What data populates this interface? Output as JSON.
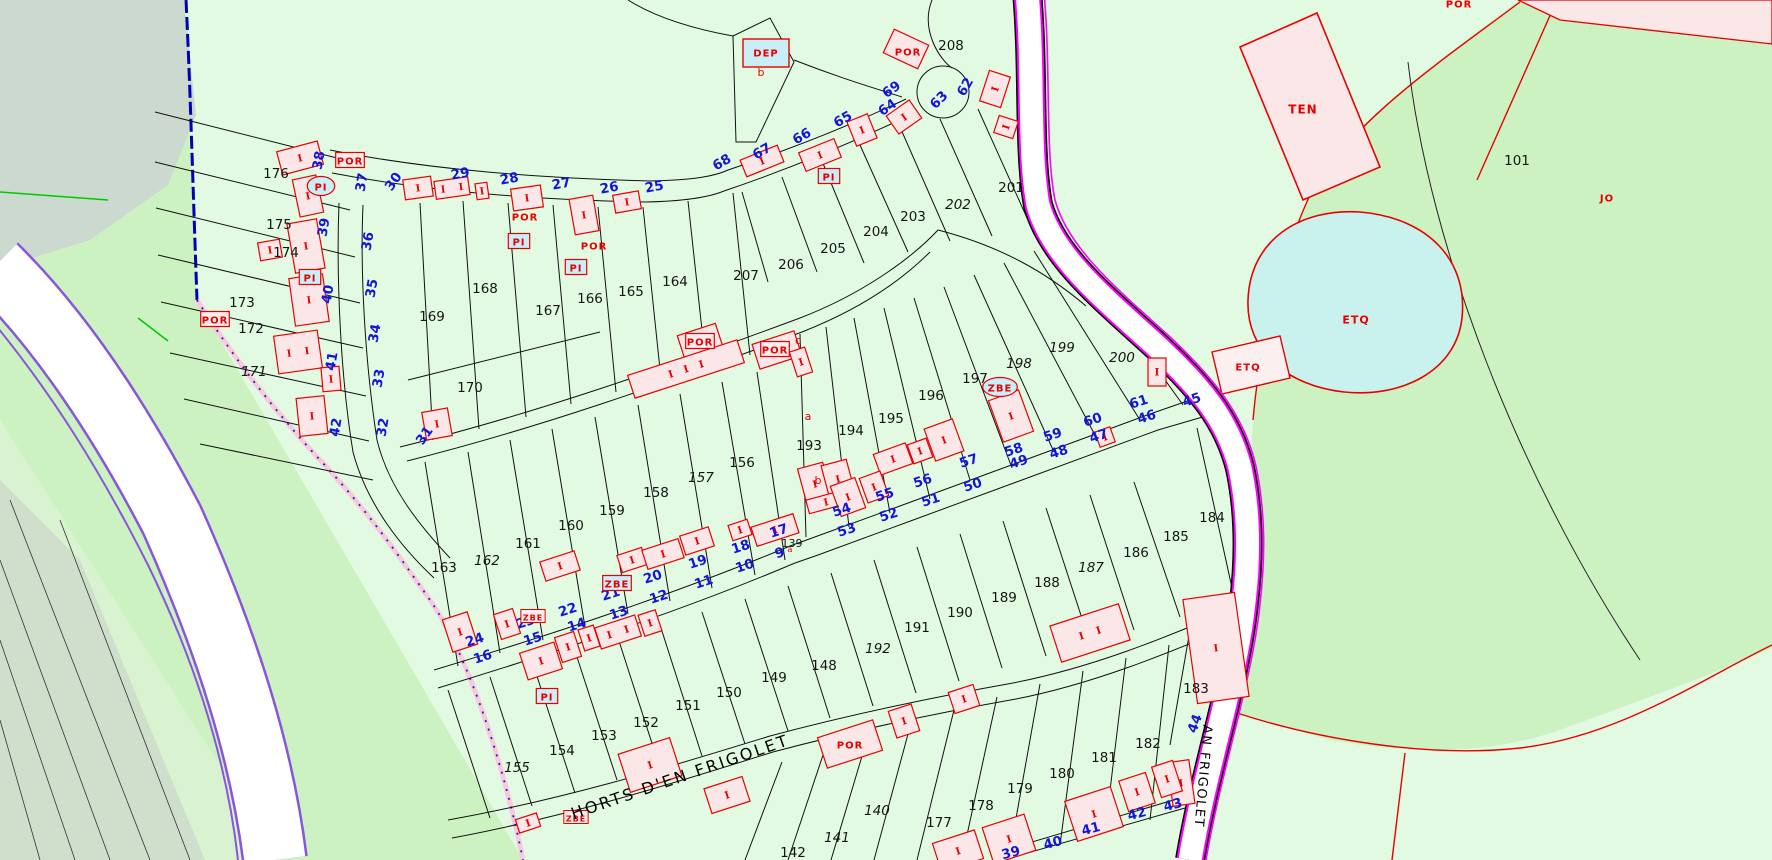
{
  "map": {
    "title": "cadastral parcel map",
    "colors": {
      "bg_light_green": "#E2FAE2",
      "medium_green": "#CDF2C2",
      "gray_green_tl": "#CCD9CE",
      "gray_green_bl": "#CFDFCB",
      "pale_west": "#D9F2CF",
      "road_white": "#FFFFFF",
      "road_violet": "#8A55DD",
      "road_magenta": "#FF00FF",
      "boundary_blue": "#0000B4",
      "boundary_pink": "#F9C9DC",
      "parcel_line": "#111111",
      "building_fill": "#FBE7E7",
      "building_red": "#E80000",
      "cyan_box": "#C9EEF8",
      "pond_fill": "#C9F2EE",
      "house_number_blue": "#1515D8",
      "green_line": "#00C800"
    },
    "street_names": [
      {
        "t": "HORTS D'EN FRIGOLET",
        "x": 682,
        "y": 782,
        "r": -19,
        "s": 16,
        "ls": 2.5
      },
      {
        "t": "AN FRIGOLET",
        "x": 1199,
        "y": 776,
        "r": 95,
        "s": 13,
        "ls": 1.5
      }
    ],
    "parcel_labels": [
      {
        "t": "139",
        "x": 792,
        "y": 547,
        "s": 11
      },
      {
        "t": "140",
        "x": 877,
        "y": 815,
        "it": 1
      },
      {
        "t": "141",
        "x": 837,
        "y": 842,
        "it": 1
      },
      {
        "t": "142",
        "x": 793,
        "y": 857
      },
      {
        "t": "148",
        "x": 824,
        "y": 670
      },
      {
        "t": "149",
        "x": 774,
        "y": 682
      },
      {
        "t": "150",
        "x": 729,
        "y": 697
      },
      {
        "t": "151",
        "x": 688,
        "y": 710
      },
      {
        "t": "152",
        "x": 646,
        "y": 727
      },
      {
        "t": "153",
        "x": 604,
        "y": 740
      },
      {
        "t": "154",
        "x": 562,
        "y": 755
      },
      {
        "t": "155",
        "x": 517,
        "y": 772,
        "it": 1
      },
      {
        "t": "156",
        "x": 742,
        "y": 467
      },
      {
        "t": "157",
        "x": 701,
        "y": 482,
        "it": 1
      },
      {
        "t": "158",
        "x": 656,
        "y": 497
      },
      {
        "t": "159",
        "x": 612,
        "y": 515
      },
      {
        "t": "160",
        "x": 571,
        "y": 530
      },
      {
        "t": "161",
        "x": 528,
        "y": 548
      },
      {
        "t": "162",
        "x": 487,
        "y": 565,
        "it": 1
      },
      {
        "t": "163",
        "x": 444,
        "y": 572
      },
      {
        "t": "164",
        "x": 675,
        "y": 286
      },
      {
        "t": "165",
        "x": 631,
        "y": 296
      },
      {
        "t": "166",
        "x": 590,
        "y": 303
      },
      {
        "t": "167",
        "x": 548,
        "y": 315
      },
      {
        "t": "168",
        "x": 485,
        "y": 293
      },
      {
        "t": "169",
        "x": 432,
        "y": 321
      },
      {
        "t": "170",
        "x": 470,
        "y": 392
      },
      {
        "t": "171",
        "x": 254,
        "y": 376,
        "it": 1
      },
      {
        "t": "172",
        "x": 251,
        "y": 333
      },
      {
        "t": "173",
        "x": 242,
        "y": 307
      },
      {
        "t": "174",
        "x": 286,
        "y": 257
      },
      {
        "t": "175",
        "x": 279,
        "y": 229
      },
      {
        "t": "176",
        "x": 276,
        "y": 178
      },
      {
        "t": "177",
        "x": 939,
        "y": 827
      },
      {
        "t": "178",
        "x": 981,
        "y": 810
      },
      {
        "t": "179",
        "x": 1020,
        "y": 793
      },
      {
        "t": "180",
        "x": 1062,
        "y": 778
      },
      {
        "t": "181",
        "x": 1104,
        "y": 762
      },
      {
        "t": "182",
        "x": 1148,
        "y": 748
      },
      {
        "t": "183",
        "x": 1196,
        "y": 693
      },
      {
        "t": "184",
        "x": 1212,
        "y": 522
      },
      {
        "t": "185",
        "x": 1176,
        "y": 541
      },
      {
        "t": "186",
        "x": 1136,
        "y": 557
      },
      {
        "t": "187",
        "x": 1091,
        "y": 572,
        "it": 1
      },
      {
        "t": "188",
        "x": 1047,
        "y": 587
      },
      {
        "t": "189",
        "x": 1004,
        "y": 602
      },
      {
        "t": "190",
        "x": 960,
        "y": 617
      },
      {
        "t": "191",
        "x": 917,
        "y": 632
      },
      {
        "t": "192",
        "x": 878,
        "y": 653,
        "it": 1
      },
      {
        "t": "193",
        "x": 809,
        "y": 450
      },
      {
        "t": "194",
        "x": 851,
        "y": 435
      },
      {
        "t": "195",
        "x": 891,
        "y": 423
      },
      {
        "t": "196",
        "x": 931,
        "y": 400
      },
      {
        "t": "197",
        "x": 975,
        "y": 383
      },
      {
        "t": "198",
        "x": 1019,
        "y": 368,
        "it": 1
      },
      {
        "t": "199",
        "x": 1062,
        "y": 352,
        "it": 1
      },
      {
        "t": "200",
        "x": 1122,
        "y": 362,
        "it": 1
      },
      {
        "t": "201",
        "x": 1011,
        "y": 192
      },
      {
        "t": "202",
        "x": 958,
        "y": 209,
        "it": 1
      },
      {
        "t": "203",
        "x": 913,
        "y": 221
      },
      {
        "t": "204",
        "x": 876,
        "y": 236
      },
      {
        "t": "205",
        "x": 833,
        "y": 253
      },
      {
        "t": "206",
        "x": 791,
        "y": 269
      },
      {
        "t": "207",
        "x": 746,
        "y": 280
      },
      {
        "t": "208",
        "x": 951,
        "y": 50
      },
      {
        "t": "101",
        "x": 1517,
        "y": 165
      }
    ],
    "house_numbers": [
      {
        "t": "25",
        "x": 655,
        "y": 191,
        "r": -10
      },
      {
        "t": "26",
        "x": 610,
        "y": 192,
        "r": -10
      },
      {
        "t": "27",
        "x": 562,
        "y": 188,
        "r": -10
      },
      {
        "t": "28",
        "x": 510,
        "y": 183,
        "r": -10
      },
      {
        "t": "29",
        "x": 461,
        "y": 178,
        "r": -10
      },
      {
        "t": "30",
        "x": 397,
        "y": 184,
        "r": -55
      },
      {
        "t": "37",
        "x": 366,
        "y": 183,
        "r": -80
      },
      {
        "t": "36",
        "x": 372,
        "y": 242,
        "r": -80
      },
      {
        "t": "35",
        "x": 376,
        "y": 289,
        "r": -80
      },
      {
        "t": "34",
        "x": 379,
        "y": 334,
        "r": -80
      },
      {
        "t": "33",
        "x": 383,
        "y": 379,
        "r": -80
      },
      {
        "t": "32",
        "x": 387,
        "y": 428,
        "r": -80
      },
      {
        "t": "31",
        "x": 428,
        "y": 438,
        "r": -55
      },
      {
        "t": "38",
        "x": 323,
        "y": 161,
        "r": -80
      },
      {
        "t": "39",
        "x": 328,
        "y": 228,
        "r": -80
      },
      {
        "t": "40",
        "x": 332,
        "y": 295,
        "r": -80
      },
      {
        "t": "41",
        "x": 336,
        "y": 362,
        "r": -80
      },
      {
        "t": "42",
        "x": 340,
        "y": 428,
        "r": -80
      },
      {
        "t": "68",
        "x": 724,
        "y": 166,
        "r": -30
      },
      {
        "t": "67",
        "x": 764,
        "y": 155,
        "r": -30
      },
      {
        "t": "66",
        "x": 804,
        "y": 140,
        "r": -30
      },
      {
        "t": "65",
        "x": 845,
        "y": 123,
        "r": -30
      },
      {
        "t": "64",
        "x": 890,
        "y": 111,
        "r": -35
      },
      {
        "t": "69",
        "x": 894,
        "y": 93,
        "r": -35
      },
      {
        "t": "63",
        "x": 942,
        "y": 103,
        "r": -45
      },
      {
        "t": "62",
        "x": 969,
        "y": 89,
        "r": -60
      },
      {
        "t": "24",
        "x": 476,
        "y": 644,
        "r": -18
      },
      {
        "t": "23",
        "x": 527,
        "y": 626,
        "r": -18
      },
      {
        "t": "22",
        "x": 569,
        "y": 614,
        "r": -18
      },
      {
        "t": "21",
        "x": 612,
        "y": 598,
        "r": -18
      },
      {
        "t": "20",
        "x": 654,
        "y": 581,
        "r": -18
      },
      {
        "t": "19",
        "x": 699,
        "y": 566,
        "r": -18
      },
      {
        "t": "18",
        "x": 742,
        "y": 551,
        "r": -18
      },
      {
        "t": "17",
        "x": 780,
        "y": 535,
        "r": -18
      },
      {
        "t": "16",
        "x": 484,
        "y": 661,
        "r": -18
      },
      {
        "t": "15",
        "x": 534,
        "y": 643,
        "r": -18
      },
      {
        "t": "14",
        "x": 578,
        "y": 629,
        "r": -18
      },
      {
        "t": "13",
        "x": 620,
        "y": 617,
        "r": -18
      },
      {
        "t": "12",
        "x": 660,
        "y": 601,
        "r": -18
      },
      {
        "t": "11",
        "x": 705,
        "y": 586,
        "r": -18
      },
      {
        "t": "10",
        "x": 746,
        "y": 570,
        "r": -18
      },
      {
        "t": "9",
        "x": 781,
        "y": 557,
        "r": -18
      },
      {
        "t": "54",
        "x": 843,
        "y": 514,
        "r": -18
      },
      {
        "t": "55",
        "x": 886,
        "y": 499,
        "r": -18
      },
      {
        "t": "56",
        "x": 924,
        "y": 485,
        "r": -18
      },
      {
        "t": "57",
        "x": 970,
        "y": 465,
        "r": -18
      },
      {
        "t": "58",
        "x": 1015,
        "y": 454,
        "r": -18
      },
      {
        "t": "59",
        "x": 1054,
        "y": 439,
        "r": -18
      },
      {
        "t": "60",
        "x": 1094,
        "y": 424,
        "r": -18
      },
      {
        "t": "61",
        "x": 1140,
        "y": 406,
        "r": -18
      },
      {
        "t": "53",
        "x": 848,
        "y": 534,
        "r": -18
      },
      {
        "t": "52",
        "x": 890,
        "y": 519,
        "r": -18
      },
      {
        "t": "51",
        "x": 932,
        "y": 504,
        "r": -18
      },
      {
        "t": "50",
        "x": 974,
        "y": 489,
        "r": -18
      },
      {
        "t": "49",
        "x": 1020,
        "y": 466,
        "r": -18
      },
      {
        "t": "48",
        "x": 1060,
        "y": 456,
        "r": -18
      },
      {
        "t": "47",
        "x": 1100,
        "y": 440,
        "r": -18
      },
      {
        "t": "46",
        "x": 1148,
        "y": 421,
        "r": -18
      },
      {
        "t": "45",
        "x": 1193,
        "y": 404,
        "r": -18
      },
      {
        "t": "44",
        "x": 1199,
        "y": 725,
        "r": -70
      },
      {
        "t": "43",
        "x": 1174,
        "y": 809,
        "r": -15
      },
      {
        "t": "42",
        "x": 1138,
        "y": 818,
        "r": -15
      },
      {
        "t": "41",
        "x": 1092,
        "y": 833,
        "r": -15
      },
      {
        "t": "40",
        "x": 1054,
        "y": 847,
        "r": -15
      },
      {
        "t": "39",
        "x": 1012,
        "y": 857,
        "r": -15
      }
    ],
    "codes": [
      {
        "t": "POR",
        "x": 350,
        "y": 161,
        "k": "b"
      },
      {
        "t": "POR",
        "x": 215,
        "y": 320,
        "k": "b"
      },
      {
        "t": "POR",
        "x": 525,
        "y": 217,
        "k": "p"
      },
      {
        "t": "POR",
        "x": 594,
        "y": 246,
        "k": "p"
      },
      {
        "t": "POR",
        "x": 700,
        "y": 342,
        "k": "b"
      },
      {
        "t": "POR",
        "x": 775,
        "y": 350,
        "k": "b"
      },
      {
        "t": "POR",
        "x": 908,
        "y": 52,
        "k": "p"
      },
      {
        "t": "POR",
        "x": 850,
        "y": 745,
        "k": "p"
      },
      {
        "t": "POR",
        "x": 1459,
        "y": 4,
        "k": "p"
      },
      {
        "t": "DEP",
        "x": 766,
        "y": 53,
        "k": "d"
      },
      {
        "t": "PI",
        "x": 321,
        "y": 187,
        "k": "e"
      },
      {
        "t": "PI",
        "x": 310,
        "y": 278,
        "k": "c"
      },
      {
        "t": "PI",
        "x": 519,
        "y": 242,
        "k": "c"
      },
      {
        "t": "PI",
        "x": 576,
        "y": 268,
        "k": "c"
      },
      {
        "t": "PI",
        "x": 829,
        "y": 177,
        "k": "c"
      },
      {
        "t": "PI",
        "x": 547,
        "y": 697,
        "k": "c"
      },
      {
        "t": "ZBE",
        "x": 617,
        "y": 584,
        "k": "c"
      },
      {
        "t": "ZBE",
        "x": 1000,
        "y": 388,
        "k": "e"
      },
      {
        "t": "ZBE",
        "x": 533,
        "y": 617,
        "k": "t"
      },
      {
        "t": "ZBE",
        "x": 576,
        "y": 818,
        "k": "t"
      },
      {
        "t": "TEN",
        "x": 1303,
        "y": 110,
        "k": "p",
        "s": 12
      },
      {
        "t": "ETQ",
        "x": 1356,
        "y": 320,
        "k": "p",
        "s": 11
      },
      {
        "t": "ETQ",
        "x": 1248,
        "y": 367,
        "k": "p"
      },
      {
        "t": "JO",
        "x": 1607,
        "y": 198,
        "k": "p"
      }
    ],
    "building_letters": [
      {
        "t": "b",
        "x": 761,
        "y": 76
      },
      {
        "t": "a",
        "x": 808,
        "y": 420
      },
      {
        "t": "b",
        "x": 818,
        "y": 484
      },
      {
        "t": "c",
        "x": 798,
        "y": 344
      },
      {
        "t": "a",
        "x": 790,
        "y": 552,
        "s": 8
      }
    ]
  },
  "buildings": [
    [
      300,
      158,
      42,
      24,
      -15,
      1
    ],
    [
      308,
      196,
      24,
      38,
      -12,
      1
    ],
    [
      306,
      246,
      30,
      50,
      -10,
      1
    ],
    [
      309,
      300,
      34,
      48,
      -8,
      1
    ],
    [
      298,
      352,
      44,
      38,
      -8,
      2
    ],
    [
      331,
      379,
      18,
      24,
      -5,
      1
    ],
    [
      312,
      416,
      28,
      38,
      -6,
      1
    ],
    [
      270,
      250,
      22,
      18,
      -10,
      1
    ],
    [
      418,
      188,
      28,
      20,
      -8,
      1
    ],
    [
      452,
      188,
      34,
      18,
      -8,
      2
    ],
    [
      482,
      191,
      12,
      16,
      -8,
      1
    ],
    [
      527,
      198,
      30,
      22,
      -8,
      1
    ],
    [
      584,
      215,
      24,
      36,
      -10,
      1
    ],
    [
      627,
      202,
      26,
      18,
      -10,
      1
    ],
    [
      762,
      161,
      40,
      18,
      -22,
      1
    ],
    [
      820,
      155,
      38,
      20,
      -22,
      1
    ],
    [
      862,
      130,
      22,
      26,
      -22,
      1
    ],
    [
      904,
      117,
      28,
      22,
      -35,
      1
    ],
    [
      995,
      89,
      32,
      22,
      -72,
      1
    ],
    [
      1006,
      127,
      18,
      20,
      -72,
      1
    ],
    [
      906,
      49,
      38,
      26,
      25,
      0
    ],
    [
      700,
      341,
      40,
      24,
      -18,
      0
    ],
    [
      777,
      350,
      44,
      26,
      -18,
      0
    ],
    [
      686,
      369,
      115,
      24,
      -18,
      3
    ],
    [
      801,
      362,
      16,
      26,
      -18,
      1
    ],
    [
      815,
      484,
      26,
      38,
      -15,
      1
    ],
    [
      838,
      479,
      26,
      34,
      -15,
      1
    ],
    [
      826,
      502,
      38,
      14,
      -15,
      1
    ],
    [
      437,
      424,
      26,
      28,
      -10,
      1
    ],
    [
      775,
      530,
      44,
      20,
      -18,
      1
    ],
    [
      560,
      566,
      36,
      20,
      -18,
      1
    ],
    [
      632,
      560,
      26,
      18,
      -18,
      1
    ],
    [
      663,
      554,
      38,
      20,
      -18,
      1
    ],
    [
      697,
      541,
      30,
      20,
      -18,
      1
    ],
    [
      740,
      530,
      20,
      16,
      -18,
      1
    ],
    [
      460,
      632,
      26,
      34,
      -18,
      1
    ],
    [
      507,
      624,
      20,
      26,
      -18,
      1
    ],
    [
      541,
      661,
      36,
      28,
      -18,
      1
    ],
    [
      568,
      647,
      20,
      26,
      -18,
      1
    ],
    [
      589,
      638,
      16,
      22,
      -18,
      1
    ],
    [
      618,
      632,
      42,
      22,
      -18,
      2
    ],
    [
      650,
      623,
      18,
      22,
      -18,
      1
    ],
    [
      893,
      459,
      34,
      22,
      -20,
      1
    ],
    [
      920,
      451,
      20,
      20,
      -20,
      1
    ],
    [
      1011,
      416,
      32,
      44,
      -20,
      1
    ],
    [
      1105,
      437,
      16,
      16,
      -20,
      1
    ],
    [
      944,
      440,
      30,
      34,
      -20,
      1
    ],
    [
      848,
      497,
      26,
      32,
      -20,
      1
    ],
    [
      874,
      487,
      22,
      26,
      -20,
      1
    ],
    [
      1216,
      648,
      52,
      105,
      -8,
      1
    ],
    [
      1181,
      783,
      22,
      44,
      -8,
      1
    ],
    [
      650,
      765,
      54,
      40,
      -18,
      1
    ],
    [
      850,
      744,
      58,
      32,
      -18,
      0
    ],
    [
      904,
      721,
      24,
      28,
      -18,
      1
    ],
    [
      964,
      699,
      26,
      22,
      -18,
      1
    ],
    [
      1090,
      633,
      72,
      38,
      -18,
      2
    ],
    [
      727,
      795,
      40,
      26,
      -18,
      1
    ],
    [
      528,
      823,
      22,
      14,
      -18,
      1
    ],
    [
      1009,
      839,
      44,
      38,
      -18,
      1
    ],
    [
      1094,
      814,
      48,
      42,
      -18,
      1
    ],
    [
      1137,
      792,
      28,
      32,
      -18,
      1
    ],
    [
      1167,
      779,
      22,
      32,
      -18,
      1
    ],
    [
      958,
      851,
      44,
      30,
      -18,
      1
    ],
    [
      1157,
      372,
      18,
      28,
      0,
      1
    ]
  ]
}
